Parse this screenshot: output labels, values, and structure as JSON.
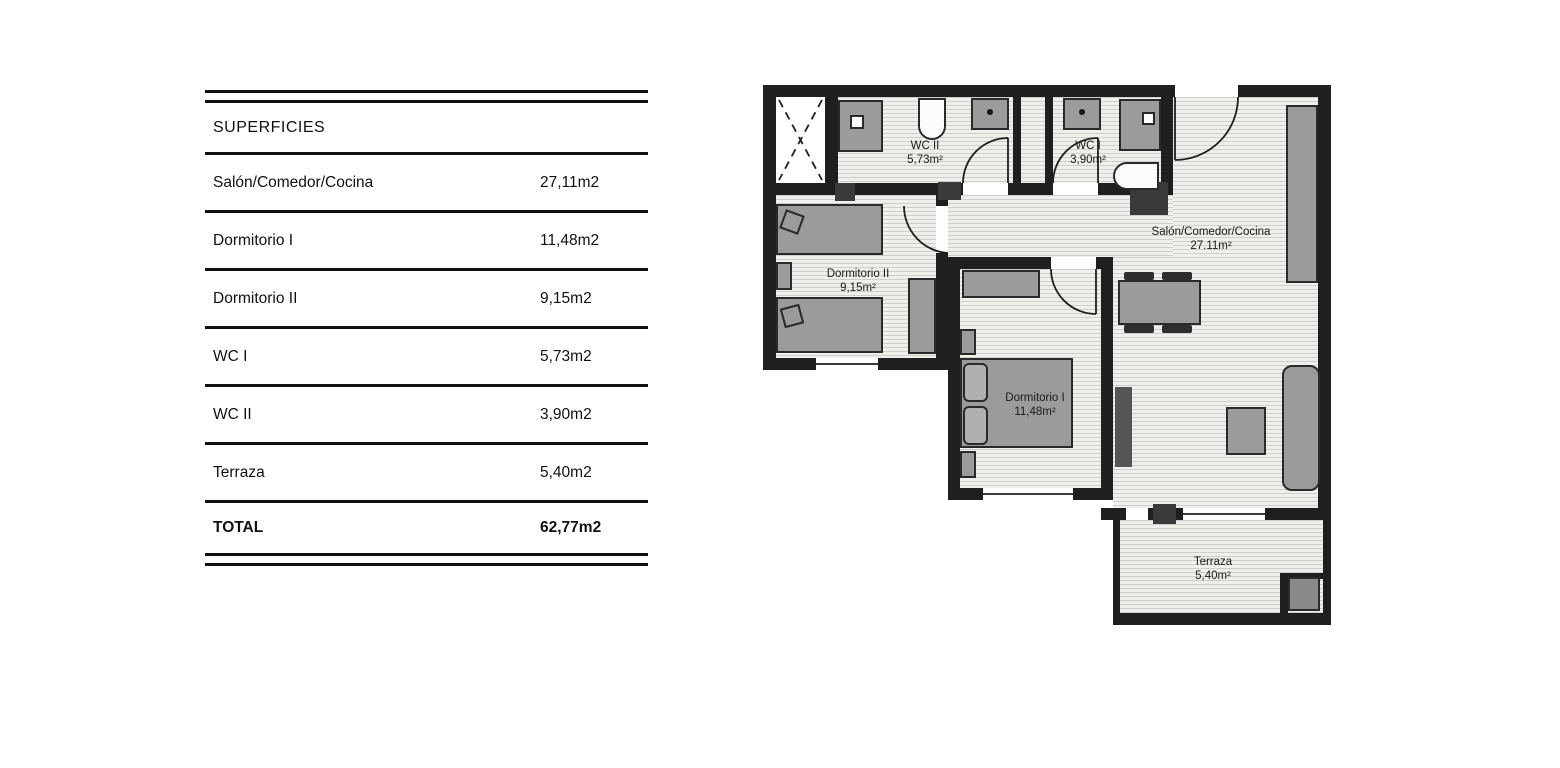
{
  "table": {
    "title": "SUPERFICIES",
    "rows": [
      {
        "label": "Salón/Comedor/Cocina",
        "value": "27,11m2"
      },
      {
        "label": "Dormitorio I",
        "value": "11,48m2"
      },
      {
        "label": "Dormitorio II",
        "value": "9,15m2"
      },
      {
        "label": "WC I",
        "value": "5,73m2"
      },
      {
        "label": "WC II",
        "value": "3,90m2"
      },
      {
        "label": "Terraza",
        "value": "5,40m2"
      }
    ],
    "total_label": "TOTAL",
    "total_value": "62,77m2"
  },
  "plan": {
    "rooms": [
      {
        "name": "WC II",
        "area": "5,73m²"
      },
      {
        "name": "WC I",
        "area": "3,90m²"
      },
      {
        "name": "Salón/Comedor/Cocina",
        "area": "27.11m²"
      },
      {
        "name": "Dormitorio II",
        "area": "9,15m²"
      },
      {
        "name": "Dormitorio I",
        "area": "11,48m²"
      },
      {
        "name": "Terraza",
        "area": "5,40m²"
      }
    ]
  },
  "colors": {
    "wall": "#1f1f1f",
    "furniture": "#9b9b9b",
    "floor": "#f0efec",
    "text": "#111111"
  }
}
